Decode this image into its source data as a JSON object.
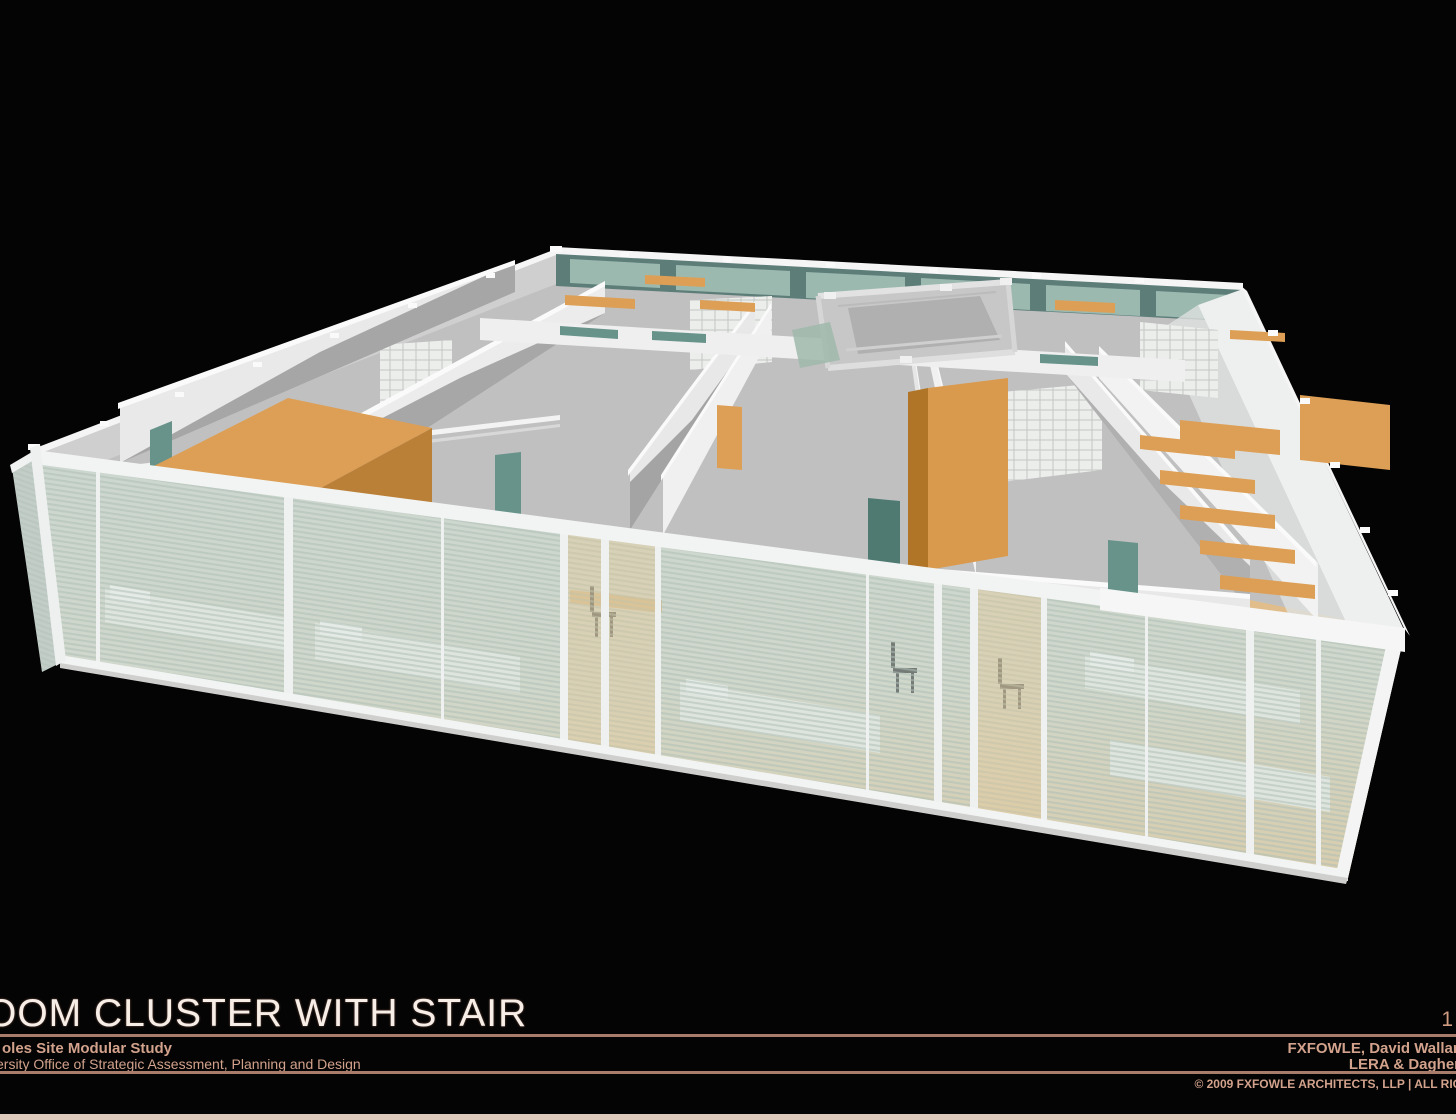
{
  "slide": {
    "title": "OOM CLUSTER WITH STAIR",
    "page_number": "1",
    "footer_left_line1": "oles Site Modular Study",
    "footer_left_line2": "ersity Office of Strategic Assessment, Planning and Design",
    "footer_right_line1": "FXFOWLE, David Wallan",
    "footer_right_line2": "LERA & Dagher",
    "copyright": "© 2009 FXFOWLE ARCHITECTS, LLP | ALL RIG"
  },
  "colors": {
    "background": "#040404",
    "title_text": "#f7eee7",
    "footer_text": "#d2a28c",
    "rule_line": "#a87c6b",
    "bottom_strip": "#dccabd",
    "wall_lit": "#ebebeb",
    "wall_white": "#f5f5f5",
    "wall_shadow": "#8f8f8f",
    "floor_gray": "#c0c0c0",
    "floor_warm": "#e3bd88",
    "wood": "#dd9f55",
    "wood_dark": "#bb8038",
    "glass": "#c9d6cf",
    "window_teal_dark": "#5d7d78",
    "window_teal_light": "#a3c0b6",
    "door_teal": "#67938a",
    "frame_white": "#f2f4f3",
    "bed_white": "#eef0ec"
  },
  "scene": {
    "description": "3D cutaway rendering of a modular dormitory room cluster with a central stair, seen from above; glass curtain wall with horizontal louver blinds across the front, white partition walls, tiled bathroom walls, wood wardrobes, shelves, desks and beds, teal doors and back windows",
    "elements": [
      "glass curtain wall with louver blinds",
      "bedrooms with beds, pillows, desks and chairs",
      "wood wardrobes and shelving",
      "central stair opening with metal frame",
      "teal doors and transom windows",
      "tiled bathroom partition walls",
      "perimeter structural rails with clamp fittings"
    ]
  }
}
